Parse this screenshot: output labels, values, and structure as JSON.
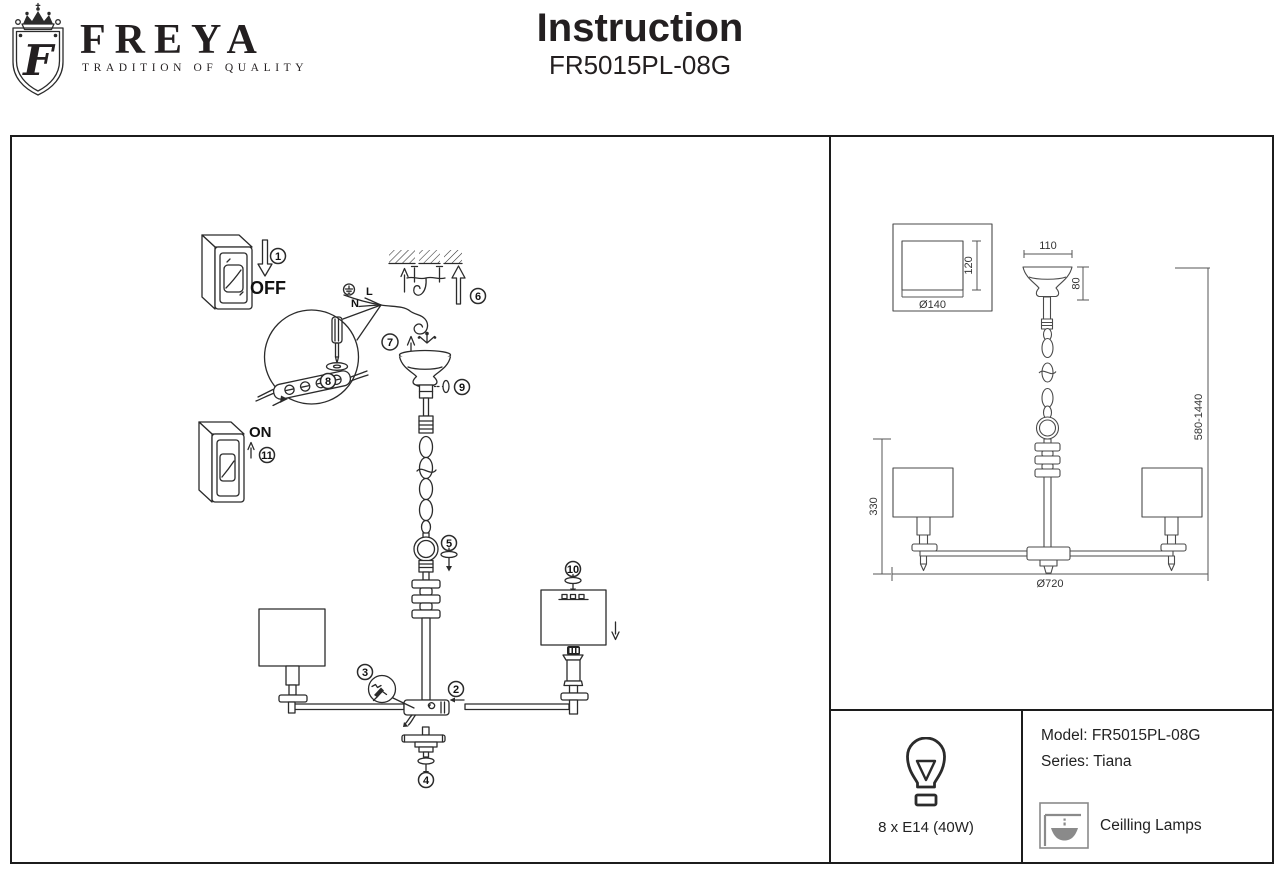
{
  "header": {
    "brand": "FREYA",
    "tagline": "TRADITION OF QUALITY",
    "title": "Instruction",
    "model": "FR5015PL-08G"
  },
  "assembly": {
    "off_label": "OFF",
    "on_label": "ON",
    "live_label": "L",
    "neutral_label": "N",
    "steps": [
      "1",
      "2",
      "3",
      "4",
      "5",
      "6",
      "7",
      "8",
      "9",
      "10",
      "11"
    ]
  },
  "dims": {
    "canopy_width": "110",
    "canopy_height": "80",
    "mount_depth": "120",
    "mount_diameter": "Ø140",
    "body_height": "330",
    "fixture_diameter": "Ø720",
    "drop_range": "580-1440"
  },
  "spec": {
    "bulb": "8 x E14 (40W)",
    "model_line": "Model: FR5015PL-08G",
    "series_line": "Series: Tiana",
    "category": "Ceilling Lamps"
  },
  "icons": {
    "crown": "crown-icon",
    "shield": "shield-f-icon",
    "bulb": "bulb-icon",
    "ceiling_lamp": "ceiling-lamp-icon"
  },
  "colors": {
    "ink": "#231f20",
    "line": "#2b2b2b",
    "icon_gray": "#8a8a8a"
  }
}
